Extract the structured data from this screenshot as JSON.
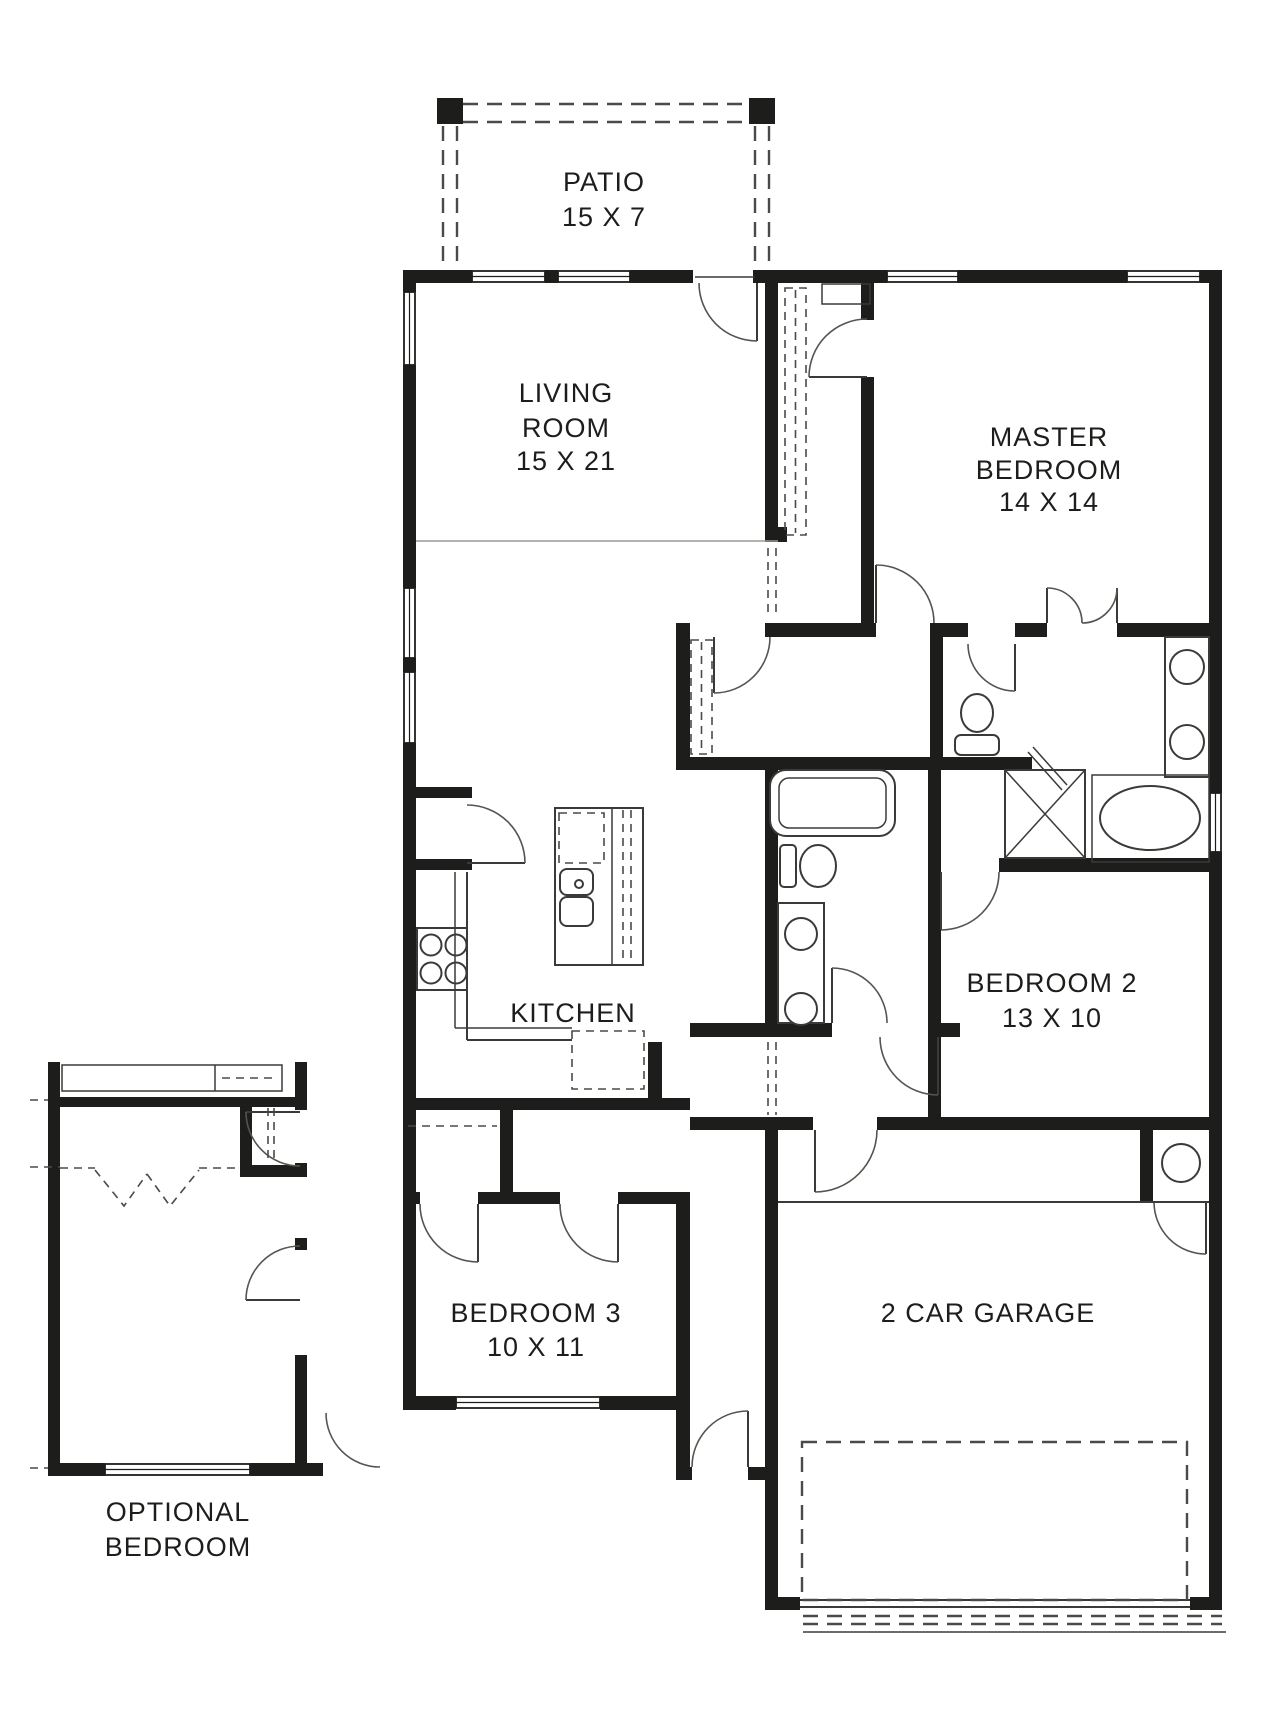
{
  "floorplan": {
    "title": "house-floor-plan",
    "rooms": {
      "patio": {
        "name": "PATIO",
        "dims": "15 X 7"
      },
      "living_room": {
        "line1": "LIVING",
        "line2": "ROOM",
        "dims": "15 X 21"
      },
      "master_bedroom": {
        "line1": "MASTER",
        "line2": "BEDROOM",
        "dims": "14 X 14"
      },
      "kitchen": {
        "name": "KITCHEN"
      },
      "bedroom2": {
        "name": "BEDROOM 2",
        "dims": "13 X 10"
      },
      "bedroom3": {
        "name": "BEDROOM 3",
        "dims": "10 X 11"
      },
      "garage": {
        "name": "2 CAR GARAGE"
      },
      "optional_bedroom": {
        "line1": "OPTIONAL",
        "line2": "BEDROOM"
      }
    },
    "colors": {
      "wall": "#1d1d1b",
      "line": "#3a3a38",
      "background": "#ffffff"
    }
  }
}
